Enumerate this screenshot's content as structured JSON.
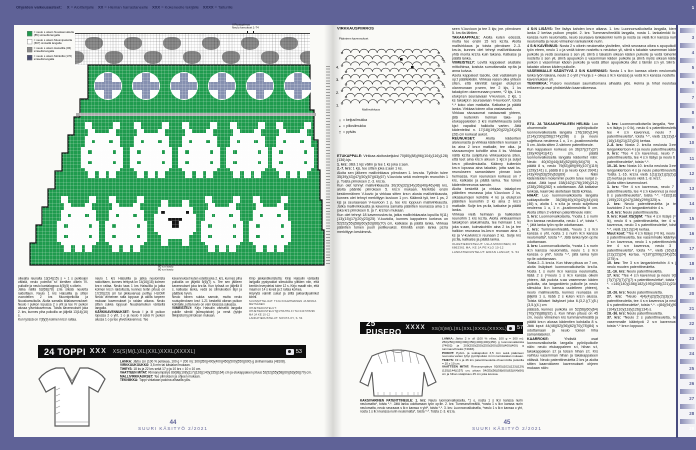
{
  "topbar": {
    "segments": [
      {
        "b": "Ohjeiden vaikeusasteet:",
        "t": ""
      },
      {
        "b": "X",
        "t": "= Aloittelijalle"
      },
      {
        "b": "XX",
        "t": "= Hieman harrastaneelle"
      },
      {
        "b": "XXX",
        "t": "= Kokeneelle tekijälle"
      },
      {
        "b": "XXXX",
        "t": "= Taiturille"
      }
    ]
  },
  "ruler": {
    "numbers": [
      "1",
      "2",
      "3",
      "4",
      "5",
      "6",
      "7",
      "8",
      "9",
      "10",
      "11",
      "12",
      "13",
      "14",
      "15",
      "16",
      "17",
      "18",
      "19",
      "20",
      "21",
      "22",
      "23",
      "24",
      "25",
      "26",
      "27",
      "28",
      "29"
    ]
  },
  "left_page": {
    "chart": {
      "top_label1": "II Ruutupiirros",
      "top_label2": "Neulo kerrokset 1-74",
      "bottom_label1": "80 s:n kuvio",
      "bottom_label2": "80 s:n kuvio",
      "legend": [
        {
          "color": "#1f9b4e",
          "text": "= neulo s oikein Nuuskamuikulla (85) sinisellä langalla"
        },
        {
          "color": "#ffffff",
          "text": "= neulo s oikein Muumipeikolla (667) sinisellä langalla"
        },
        {
          "color": "#8c8c8c",
          "text": "= neulo s oikein Haisulilla (06) sinisellä langalla"
        },
        {
          "color": "#4a4e72",
          "text": "= neulo s oikein Mörköllä (176) sinisellä langalla"
        }
      ],
      "motifs": {
        "bunny": [
          ".##......##..",
          ".##......##..",
          "..##....##...",
          "..########...",
          ".##########..",
          ".##.####.##..",
          ".##########..",
          "############.",
          "##.######.##.",
          "############.",
          "############.",
          "##.######.##.",
          "############.",
          ".##########..",
          "..##.##.##...",
          "..##.##.##..."
        ],
        "sheep": [
          "..##....##..",
          "..##....##..",
          ".##########.",
          ".#@######@#.",
          "############",
          "####@@@@####",
          "#####@@#####",
          "#####@@#####",
          "############",
          ".##########.",
          "..########..",
          "..##....##..",
          "..##....##.."
        ]
      }
    },
    "columns": {
      "c1": [
        {
          "l": "",
          "t": "oikealta reunalta 13(14)(15) s + 1 s puikkojen välistä, neulo poimitut s:t kiertäen oikein IV-puikolle ja neulo kantalappua 4(5)(5) s oikein."
        },
        {
          "l": "",
          "t": "Jatka näillä 62(68)(78) s:lla sileää neuletta raidoittaen. Neulo 1 krs Haisulilla ja sitten vuorotellen 2 krs Muumipeikolla ja Nuuskamuikulla. Aloita samalla kiilakavennukset: Neulo I puikon lopussa 2 o yht ja tee IV puikon alussa ylivetokavennus. Toista kavennukset joka 2. krs, kunnes piha puikoilla on jäljellä 13(14)(16) s."
        },
        {
          "l": "",
          "t": "Kun työssä on 7(8)(9) kolmen krs:n raitaa."
        }
      ],
      "c2": [
        {
          "l": "",
          "t": "neulo 1 krs Haisulilla ja jatka neulomista raidoittaen, kunnes tehtynä on 14(16)(18) kolmen krs:n raitaa. Neulo taas 1 krs Haisulilla ja jatka kolmen krs:n raidoitusta, kunnes terän pituus on 17(20)(23) cm tai pikkuvarvas peittyy. HUOM! Neulo viimeinen raita loppuun ja aloita tarpeen mukaan kavennukset jo raidan aikana. Neulo sitten sukka loppuun Nuuskamuikun värisellä langalla."
        },
        {
          "l": "KÄRKIKAVENNUKSET:",
          "t": "Neulo I ja III puikon lopussa 2 o yht, 1 o ja neulo II sekä IV puikon alussa 1 o ja tee ylivetokavennus. Tee"
        }
      ],
      "c3": [
        {
          "l": "",
          "t": "kavennukset kuten edellä joka 2. krs, kunnes piha puikoilla on jäljellä 5(6)(7) s. Tee sen jälkeen kavennukset joka krs:lla. Kun työssä on jäljellä 8 s, katkaise lanka, vedä se silmukoiden läpi ja päättele hyvin."
        },
        {
          "l": "",
          "t": "Neulo toinen sukka samoin, mutta neulo ruutupiirroksen krs:t 1-21 keskeltä oikean puikon kohdalle, jotta kuvio on vain toisessa sukassa."
        },
        {
          "l": "VIIMEISTELY:",
          "t": "Kirjo Haisulin värisellä langalla pukille silmät (silmupistoin) ja nenä (tyhjin tikkipistoin) piirroksen mukaan."
        }
      ],
      "c4": [
        {
          "l": "",
          "t": "Kirjo jakkardikoristetta: Kirjo Haisulin värisellä langalla pystyraidat silmukoita ylittäen niin, että kentän leveydeksi tulee 12 s. Kirjo maalit niin, että maali on 14 s leveä ja 2 raitaa korkea."
        },
        {
          "l": "",
          "t": "Höyrytä valmiit sukat ja silitä jakkardipalmikot kiinni."
        },
        {
          "l": "",
          "t": "SUUNNITTELIJAT: TIIJA KOLEHMAINEN JA MINNA METSÄNEN",
          "c": 1
        },
        {
          "l": "",
          "t": "OHJETIEDUSTELUT: OHJETIEDUSTELUT@VHAHTA.FI TAI 040 578296 MA JA KE 10-12",
          "c": 1
        },
        {
          "l": "",
          "t": "LANKATIEDUSTELUT: NOVITA OY, S. 54",
          "c": 1
        }
      ]
    },
    "pattern_24": {
      "title": "24 TOPPI",
      "difficulty": "XXX",
      "sizes": "XS(S)M(L)XL(XXL)XXXL(XXXXL)",
      "photo_ref": "53",
      "specs": [
        {
          "l": "LANKA:",
          "t": "Järbo Lin (100 % pellavaa, 100 g = 200 m): 300(350)(400)(400)(450)(500)(550)(600) g siniharmaata (48108)."
        },
        {
          "l": "VIRKKUUKOUKKU:",
          "t": "3,5 mm tai käsialan mukaan."
        },
        {
          "l": "TIHEYS:",
          "t": "18 ks ja 22 krs sekä 17 p ja 10 krs = 10 x 10 cm."
        },
        {
          "l": "VAATTEEN MITAT:",
          "t": "Rinnanympärys 89(98)(108)(117)(126)(140)(155)(164) cm ja etukappaleen pituus 52(52)(55)(58)(60)(63)(66)(70) cm."
        },
        {
          "l": "MALLIVIRKKAUKSET:",
          "t": "Tee piirroksen ja ohjeen mukaan."
        },
        {
          "l": "TEKNIIKKA:",
          "t": "Toppi virkataan paloina alhaalta ylös."
        }
      ]
    },
    "footer": {
      "page": "44",
      "magazine": "SUURI KÄSITYÖ 2/2021"
    }
  },
  "right_page": {
    "crochet": {
      "title": "VIRKKAUSPIIRROS",
      "top_note": "Päänteen kavennukset",
      "bottom_note": "Mallinvirkkaus",
      "numbers_left": [
        "4.",
        "3.",
        "2.",
        "1."
      ],
      "numbers_right": [
        "5.",
        "3.",
        "1."
      ],
      "legend": [
        {
          "sym": "○",
          "text": "= ketjusilmukka"
        },
        {
          "sym": "▪",
          "text": "= piilosilmukka"
        },
        {
          "sym": "†",
          "text": "= pylväs"
        },
        {
          "sym": "V",
          "text": "= V-kuvio eli tee 2 p samaan kohtaan"
        }
      ]
    },
    "col1": [
      {
        "l": "ETUKAPPALE:",
        "t": "Virkkaa aloitusketjuksi 70(80)(88)(96)(104)(116)(128)(136) kjs."
      },
      {
        "l": "1. krs:",
        "t": "Jätä 1 kjs väliin ja tee 1 ks joka s:aan."
      },
      {
        "l": "2.-7. krs:",
        "t": "1 kjs, tee sitten joka s:aan 1 ks."
      },
      {
        "l": "",
        "t": "Aloita sen jälkeen mallivirkkaus piirroksen 1. krs:sta. Työhön tulee 35(39)(43)(47)(50)(57)(63)(67) V-kuviota sekä molempiin reunoihin 1 p. Toista piirroksen 2.-3. krs:ia."
      },
      {
        "l": "",
        "t": "Kun olet tehnyt mallivirkkausta 30(30)(32)(34)(36)(40)(46)(48) krs, aloita pääntie piirroksen 5. krs:n mukaan. Merkitse ensin keskimmäinen V-kuvio ja virkkaa sitten krs:n alusta mallivirkkausta, kunnes olet tehnyt merkittyyn kuvioon 1 p:n. Käännä työ, tee 1 ps, 2 kjs ja seuraavaan V-kuvioon 1 p, tee krs loppuun mallivirkkausta. Jatka mallivirkkausta ja kavenna samalla pääntien reunassa aina 1 s joka krs piirroksen 6. ja 7. krs:ten mukaan."
      },
      {
        "l": "",
        "t": "Kun olet tehnyt 18 kavennuskrs:ta, jatka mallivirkkausta lopuilla 9(11)(13)(15)(17)(20)(23)(25) V-kuviolla, kunnes kappaleen korkeus on 52(52)(55)(58)(60)(63)(66)(70) cm, katkaise ja päätä lanka. Virkkaa pääntien toinen puoli peilikuvaksi. Kiinnitä ensin lanka ps:lla merkittyyn keskimmä-"
      }
    ],
    "col2": [
      {
        "l": "",
        "t": "seen V-kuvioon ja tee 3 kjs; jne. piirroksen 5. krs:lta lähtien."
      },
      {
        "l": "TAKAKAPPALE:",
        "t": "Aloita kuten edessä, mutta tee ensin 15 krs ks:ita. Aloita mallivirkkaus ja toista piirroksen 2.-3. krs:ia, kunnes olet tehnyt mallivirkkausta yhtä monta krs:ta kuin takana. Katkaise ja päätä lanka."
      },
      {
        "l": "VIIMEISTELY:",
        "t": "Levitä kappaleet alustalle mittoihinsa, kostuta sumuttamalla np:lta ja anna kuivua."
      },
      {
        "l": "",
        "t": "Aseta kappaleet tasolle, olat vastakkain ja op:t päällekkäin. Virkkaa vasen olka yhteen siten, että kiinnität langan etukpl:en olanreunaan p:seen, tee 2 kjs, 1 ks takakpl:en olanreunaan p:seen, *2 kjs, 1 ks etukpl:en seuraavaan V-kuvioon, 2 kjs, 1 ks takakpl:n seuraavaan V-kuvioon*, toista *-* koko olan matkalta. Katkaise ja päätä lanka. Virkkaa toinen olka vastaavasti."
      },
      {
        "l": "",
        "t": "Virkkaa sivusaumat vastaavasti yhteen, jätä kuitenkin helman taka- ja etukappaleiden 3 krs mallivirkkausta sekä kjs:t vapaiksi halkioita varten. Jätä kädenteiksi n. 17(18)(19)(20)(22)(24)(25)(26) cm korkeat aukot."
      },
      {
        "l": "REUNUKSET:",
        "t": "Aloita kädentien alareunasta ja virkkaa kädentien reunaan 3 ks aina 2 krs:n matkalle, tee olka- ja sivusaumojen kohdille aina 4 ks. Virkkaa näitä ks:ita suljettuna virkkauksena siten, että teet aina krs:n alkuun 1 kjs:n ja suljet krs:n piilosilmukalla. Käänny kuitenkin krs:n lopussa aina takaisin, jotta saat ks-reunukseen samanlaisen pinnan kuin helmassa. Kun reunuksen korkeus on 7 krs, katkaise ja päätä lanka. Tee toinen kädentienreunus samoin."
      },
      {
        "l": "",
        "t": "Aloita keskeltä ja virkkaa takakpl:en pääntien reunassa joka V-kuvioon 2 ks, olkasaumojen kohdille 4 ks ja etukpl:en pääntien reunoihin 3 ks aina 2 krs:n matkalle. Sulje krs ps:lla, katkaise ja päätä lanka."
      },
      {
        "l": "",
        "t": "Virkkaa vielä helmaan ja halkioiden reunoihin 1 krs ks:ita. Aloita virkkaaminen takakpl:en alakulmasta, tee helmaan 1 ks joka s:aan, kulmakohtiin aina 2 ks ja tee halkion reunassa ks-krs:n reunaan aina 1 ks ja V-kuviokrs:n reunaan 2 ks. Sulje krs ps:lla, katkaise ja päätä lanka."
      },
      {
        "l": "",
        "t": "OHJETIEDUSTELUT: ULLA MIKKONEN, 03 6862361 MA, KE JA PE KLO 10-12",
        "c": 1
      },
      {
        "l": "",
        "t": "LANKATIEDUSTELUT: EIRAN LANGAT, S. 54",
        "c": 1
      }
    ],
    "col34_top": [
      {
        "l": "4 S:N LISÄYS:",
        "t": "Tee lisäys kahden krs:n aikana. 1. krs: Luonnonvalkoisella langalla, kierrä lanka 2 kertaa puikon ympäri. 2. krs: Tummanvihreällä langalla, nosta 1. lankalenkki lk:n kanssa nurin neulomatta, neulo seuraava lankalenkki nurin ja nosta se vielä lk:n kanssa nurin neulomatta ja neulo viimeinen lankalenkki nurin."
      },
      {
        "l": "4 S:N KAVENNUS:",
        "t": "Nosta 2 s oikein neulomatta yksitellen, siirrä seuraava oikea s apupuikolle työn eteen, neulo 1 o ja vedä toinen nostettu s neulotun yli, siirrä s takaisin vasemman käden puikolle ja vedä seuraava s sen yli, siirrä s takaisin oikean käden puikolle ja vedä toinenkin nostettu s sen yli, siirrä apupuikon s vasemman käden puikolle ja siirrä myös oikean käden puikon s vasemman käden puikolle ja vedä sitten apupuikolla ollut s tämän s:n yli. Siirrä s takaisin oikean käden puikolle."
      },
      {
        "l": "VASEMMALLE KÄÄNTYVÄ 2 S:N KAVENNUS:",
        "t": "Nosta 1 s lk:n kanssa oikein neulomatta, lanka työn takana, neulo 2 o yht (=nurja s + oikea s lk:n kanssa) ja vedä lk:n kanssa nostettu s kavennuksen yli."
      },
      {
        "l": "TEKNIIKKA:",
        "t": "Pusero neulotaan saumattomana alhaalta ylös. Helma ja hihat neulotaan erikseen ja osat yhdistetään kaarrokkeessa."
      }
    ],
    "col3": [
      {
        "l": "ETU- JA TAKAKAPPALEEN HELMA:",
        "t": "Luo ohuemmalle pyöröpuikolle luonnonvalkoisella langalla 176(180)(194)(214)(230)(256)(274)(298) s ja neulo suljettuna neuleena 1 o, 1 n -joustinneuletta 5 cm. Aloita sitten 2-värinen patenttineule."
      },
      {
        "l": "",
        "t": "Kun kappaleen korkeus on 36(37)(37)(37)(39)(40)(41)(41) cm, päätä luonnonvalkoisella langalla kädentiet näin: Neulo 40(40)(44)(48)(52)(60)(64)(70) s, päätä 8 s, neulo 79(83)(89)(99)(107)(119)(129)(141) s, päätä 8 s ja neulo loput 39(41)(43)(49)(53)(59)(63)(69) s. Näin kädenteiden molemmin puolin tulee nurjat s-raidat. Jätä loput 158(162)(176)(196)(212)(238)(256)(282) s odottamaan. Älä katkaise lankoja, kaarroke aloitetaan tästä kohtaa."
      },
      {
        "l": "HIHAT:",
        "t": "Luo luonnonvalkoisella langalla sukkapuikoille 36(38)(40)(40)(42)(44)(44)(46) s, aloita 1 n s:lla ja neulo suljettuna neuleena 1 o, 1 n -joustinneuletta 5 cm. Aloita sitten 2-värinen patenttineule näin:"
      },
      {
        "l": "1. krs:",
        "t": "Luonnonvalkoisella, *nosta 1 s nurin lk:n kanssa neulomatta, neulo 1 o*, toista *-*, jätä lanka työn np:lle odottamaan."
      },
      {
        "l": "2. krs:",
        "t": "Tummanvihreällä, *neulo 1 s lk:n kanssa o yht, nosta 1 s nurin lk:n kanssa neulomatta*, toista *-*. Jätä lanka työn op:lle odottamaan."
      },
      {
        "l": "3. krs:",
        "t": "Luonnonvalkoisella, *nosta 1 s nurin lk:n kanssa neulomatta, neulo 1 s lk:n kanssa o yht*, toista *-*, jätä lanka työn np:lle odottamaan."
      },
      {
        "l": "",
        "t": "Toista 2.-3. krs:ia. Kun hihan pituus on 7 cm, aloita lisäykset luonnonvalkoisella krs:lla. Nosta 1 s nurin lk:n kanssa neulomatta, lisää 2 s (=neulo 1 s lk:n kanssa oikein yhteen, älä pudota s:aa vasemman käden puikolta, ota langankierto puikolle ja neulo silmukka lk:n kanssa uudelleen yhteen), neulo mallineuletta, kunnes reunassa on jäljellä 1 s, lisää 2 s kuten krs:n alussa. Toista tällaiset lisäykset joka 6.(3,2.)(7.)(5.)(3,5.)(4.) cm"
      },
      {
        "l": "",
        "t": "päässä, kunnes puikolla on 52(56)(60)(64)(70)(78)(86)(92) s. Kun hihan pituus on 45 cm, neulo viimeinen krs tummanvihreällä ja päätä krs:n alussa kädentien kohdalla 8 s. Jätä loput 44(48)(52)(56)(62)(70)(78)(84) s odottamaan ja neulo toinen hiha samanlaiseksi."
      },
      {
        "l": "KAARROKE:",
        "t": "Yhdistä osat luonnonvalkoisella langalla pyöröpuikolle näin: neulo etukappaleen s:t, hihan s:t, takakappaleen s:t ja toisen hihan s:t. Krs vaihtuu vasemman hihan ja takakappaleen välissä. Neulo patenttineuletta 2 krs ja aloita sitten kaarrokkeen kavennukset ohjeen mukaan näin:"
      }
    ],
    "col4": [
      {
        "l": "1. krs:",
        "t": "Luonnonvalkoisella langalla, *tee 4 s:n lisäys (= 0 lk), neulo 6 s patenttineuletta, tee 4 s:n kavennus, neulo 7 s patenttineuletta*, toista *-*, vielä 13(13)(14)(16)(18)(21)(22)(24) kertaa."
      },
      {
        "l": "2.-8. krs:",
        "t": "Nosta 2. krs:lla neulosta 3:een langankiertoon 4 s ja neulo patenttineuletta."
      },
      {
        "l": "9. krs:",
        "t": "*Tee 4 s:n kavennus, neulo 7 s patenttineuletta, tee 4 s:n lisäys ja neulo 6 s patenttineuletta*, toista *-*."
      },
      {
        "l": "10.-16. krs:",
        "t": "Nosta 10. krs:lla neulosta 3:een langankiertoon 4 s ja neulo patenttineuletta. Toista 1.-16. krs:ia vielä 1(1)(1)(1)(2)(2)(2)(2) kertaa ja neulo vielä 1.-8. krs:t."
      },
      {
        "l": "",
        "t": "Aloita sitten kavennukset."
      },
      {
        "l": "1. krs:",
        "t": "*Tee 4 s:n kavennus, neulo 7 s patenttineuletta, tee 4 s:n kavennus ja neulo 6 s patenttineuletta*, toista *-*. =182(182)(195)(221)(247)(286)(299)(325) s."
      },
      {
        "l": "2. krs:",
        "t": "Neulo patenttineuletta ja tee kuvioiden 2 s:n langankiertoihin 4 s."
      },
      {
        "l": "3.-8. krs:",
        "t": "Neulo patenttineuletta."
      },
      {
        "l": "9. krs: Koot XS(S)/M:",
        "t": "*Tee 4 s:n lisäys (=0 lk), neulo 6 s patenttineuletta, tee 4 s:n kavennus, neulo 3 s patenttineuletta*, toista *-*, vielä 13(13)(14) kertaa."
      },
      {
        "l": "Muut koot:",
        "t": "*Tee 4 s:n lisäys (=0 lk), neulo 2 s patenttineuletta, tee vasemmalle kääntyvä 2 s:n kavennus, neulo 1 s patenttineuletta, tee 4 s:n kavennus, neulo 3 s patenttineuletta*, toista *-*, vielä (16)(18)(21)(22)(24) kertaa. =(187)(209)(234)(253)(275) s."
      },
      {
        "l": "10. krs:",
        "t": "Tee 3 s:n langankiertoihin 4 s ja neulo muuten patenttineuletta."
      },
      {
        "l": "11.-16. krs:",
        "t": "Neulo patenttineuletta."
      },
      {
        "l": "17. krs:",
        "t": "*Tee 4 s:n kavennus ja neulo 9(9)(7)(7)(7)(7)(7)(7) s patenttineuletta*, toista *-*. =140(140)(156)(182)(195)(208)(221)(234) s."
      },
      {
        "l": "18.-26. krs:",
        "t": "Neulo patenttineuletta."
      },
      {
        "l": "27. krs:",
        "t": "*Neulo 4(4)(4)(2)(5)(2)(3)(3) s patenttineuletta, tee 4 s:n kavennus ja neulo 6 s patenttineuletta*, toista *-*. =(84)(94)(90)(104)(110)(118)(126)(134) s."
      },
      {
        "l": "28.-36. krs:",
        "t": "Neulo patenttineuletta."
      },
      {
        "l": "37. krs:",
        "t": "*Neulo 2 s patenttineuletta, tee vasemmalle kääntyvä 2 s:n kavennus*, toista *-* krs:n loppuun."
      }
    ],
    "pattern_25": {
      "title": "25 PUSERO",
      "difficulty": "XXXX",
      "sizes": "XS(S)M(L)XL(XXL)XXXL(XXXXL)",
      "photo_ref": "57",
      "specs": [
        {
          "l": "LANKA:",
          "t": "Järbo 2 tr ull (100 % villaa, 100 g = 300 m): 250(250)(300)(300)(350)(400)(400)(450) g luonnonvalkoista (74602) ja 200(250)(250)(250)(300)(350)(400)(400) g tummanvihreää (74048)."
        },
        {
          "l": "PUIKOT:",
          "t": "Pyörö- ja sukkapuikot 3,5 mm sekä päänteen reunusta varten lyhyt pyöröpuikko 4 mm tai käsialan mukaan."
        },
        {
          "l": "TIHEYS:",
          "t": "19 s ja 46 krs patenttineuletta ohuemmilla puikoilla = 10 x 10 cm."
        },
        {
          "l": "VAATTEEN MITAT:",
          "t": "Rinnanympärys 92(95)(102)(123)(129)(135)(144)(157) cm, pituus 54(55)(56)(58)(60)(62)(64)(66) cm ja hihan sisäpituus 45 cm joka koossa."
        }
      ]
    },
    "patent_note": [
      {
        "l": "KAKSIVÄRINEN PATENTTINEULE: 1. krs:",
        "t": "Neulo luonnonvalkoisella, *1 o, nosta 1 s lk:n kanssa nurin neulomatta*, toista *-*. Jätä lanka odottamaan työn op:lle. 2. krs: Tummanvihreällä, *nosta 1 s lk:n kanssa nurin neulomatta, neulo seuraava s lk:n kanssa n yht*, toista *-*. 3. krs: Luonnonvalkoisella, *neulo 1 s lk:n kanssa o yht, nosta 1 s lk:n kanssa nurin neulomatta*, toista *-*. Toista 2.-3. krs:ia."
      }
    ],
    "footer": {
      "page": "45",
      "magazine": "SUURI KÄSITYÖ 2/2021"
    }
  }
}
